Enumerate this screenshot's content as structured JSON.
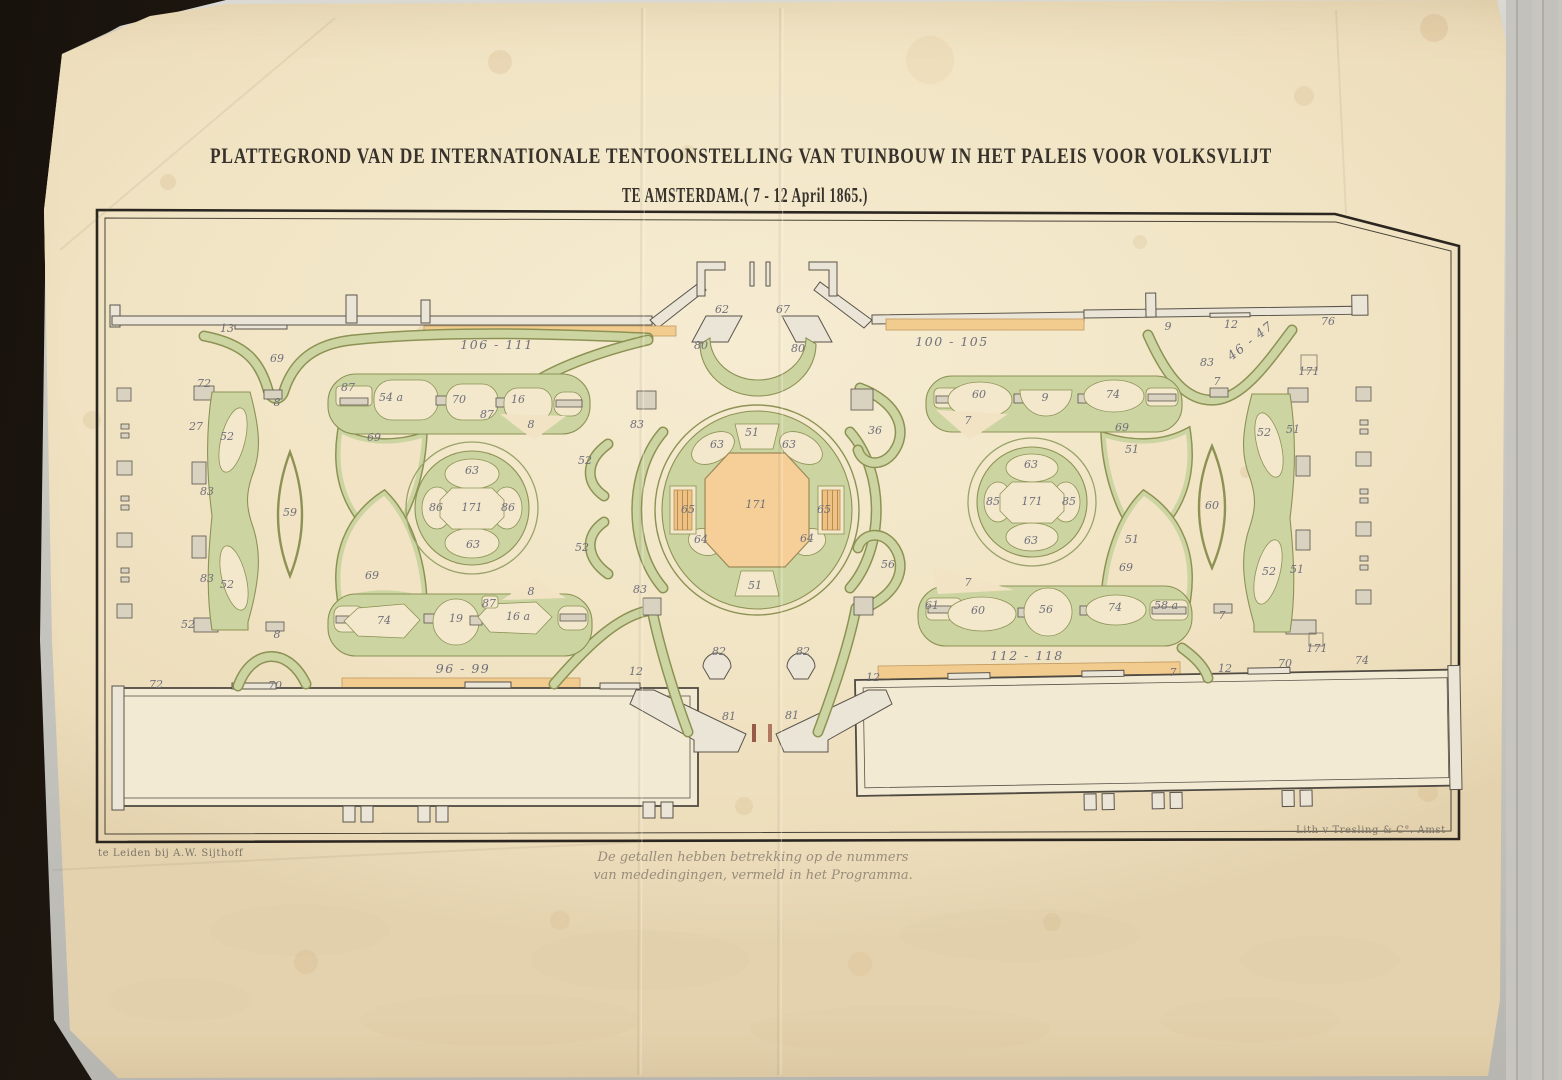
{
  "page": {
    "title_line1": "PLATTEGROND VAN DE INTERNATIONALE TENTOONSTELLING VAN TUINBOUW IN HET PALEIS VOOR VOLKSVLIJT",
    "title_line2": "TE AMSTERDAM.( 7 - 12 April 1865.)",
    "note_line1": "De getallen hebben betrekking op de nummers",
    "note_line2": "van mededingingen, vermeld in het Programma.",
    "imprint_left": "te Leiden bij A.W. Sijthoff",
    "imprint_right": "Lith v Tresling & C°. Amst"
  },
  "colors": {
    "paper": "#f1e4c4",
    "parterre_green": "#ccd5a2",
    "green_edge": "#8d9254",
    "orange": "#f2cc8f",
    "ink": "#37322b",
    "number_ink": "#6f6f7a",
    "cover_dark": "#18120c"
  },
  "plan_labels": [
    {
      "t": "13",
      "x": 227,
      "y": 332
    },
    {
      "t": "69",
      "x": 277,
      "y": 362
    },
    {
      "t": "106 - 111",
      "x": 497,
      "y": 349,
      "b": 1
    },
    {
      "t": "62",
      "x": 722,
      "y": 313
    },
    {
      "t": "67",
      "x": 783,
      "y": 313
    },
    {
      "t": "80",
      "x": 701,
      "y": 349
    },
    {
      "t": "80",
      "x": 798,
      "y": 352
    },
    {
      "t": "100 - 105",
      "x": 952,
      "y": 346,
      "b": 1
    },
    {
      "t": "9",
      "x": 1168,
      "y": 330
    },
    {
      "t": "12",
      "x": 1231,
      "y": 328
    },
    {
      "t": "76",
      "x": 1328,
      "y": 325
    },
    {
      "t": "46 - 47",
      "x": 1253,
      "y": 344,
      "b": 1,
      "r": -38
    },
    {
      "t": "83",
      "x": 1207,
      "y": 366
    },
    {
      "t": "7",
      "x": 1217,
      "y": 385
    },
    {
      "t": "171",
      "x": 1309,
      "y": 375
    },
    {
      "t": "72",
      "x": 204,
      "y": 387
    },
    {
      "t": "27",
      "x": 196,
      "y": 430
    },
    {
      "t": "52",
      "x": 227,
      "y": 440
    },
    {
      "t": "83",
      "x": 207,
      "y": 495
    },
    {
      "t": "59",
      "x": 290,
      "y": 516
    },
    {
      "t": "83",
      "x": 207,
      "y": 582
    },
    {
      "t": "52",
      "x": 227,
      "y": 588
    },
    {
      "t": "52",
      "x": 188,
      "y": 628
    },
    {
      "t": "8",
      "x": 277,
      "y": 638
    },
    {
      "t": "8",
      "x": 277,
      "y": 406
    },
    {
      "t": "87",
      "x": 348,
      "y": 391
    },
    {
      "t": "54 a",
      "x": 391,
      "y": 401
    },
    {
      "t": "70",
      "x": 459,
      "y": 403
    },
    {
      "t": "16",
      "x": 518,
      "y": 403
    },
    {
      "t": "87",
      "x": 487,
      "y": 418
    },
    {
      "t": "8",
      "x": 531,
      "y": 428
    },
    {
      "t": "69",
      "x": 374,
      "y": 441
    },
    {
      "t": "83",
      "x": 637,
      "y": 428
    },
    {
      "t": "52",
      "x": 585,
      "y": 464
    },
    {
      "t": "36",
      "x": 875,
      "y": 434
    },
    {
      "t": "63",
      "x": 472,
      "y": 474
    },
    {
      "t": "86",
      "x": 436,
      "y": 511
    },
    {
      "t": "171",
      "x": 472,
      "y": 511
    },
    {
      "t": "86",
      "x": 508,
      "y": 511
    },
    {
      "t": "63",
      "x": 473,
      "y": 548
    },
    {
      "t": "51",
      "x": 752,
      "y": 436
    },
    {
      "t": "63",
      "x": 717,
      "y": 448
    },
    {
      "t": "63",
      "x": 789,
      "y": 448
    },
    {
      "t": "65",
      "x": 688,
      "y": 513
    },
    {
      "t": "171",
      "x": 756,
      "y": 508
    },
    {
      "t": "65",
      "x": 824,
      "y": 513
    },
    {
      "t": "64",
      "x": 701,
      "y": 543
    },
    {
      "t": "64",
      "x": 807,
      "y": 542
    },
    {
      "t": "51",
      "x": 755,
      "y": 589
    },
    {
      "t": "63",
      "x": 1031,
      "y": 468
    },
    {
      "t": "85",
      "x": 993,
      "y": 505
    },
    {
      "t": "171",
      "x": 1032,
      "y": 505
    },
    {
      "t": "85",
      "x": 1069,
      "y": 505
    },
    {
      "t": "63",
      "x": 1031,
      "y": 544
    },
    {
      "t": "69",
      "x": 1122,
      "y": 431
    },
    {
      "t": "51",
      "x": 1132,
      "y": 453
    },
    {
      "t": "51",
      "x": 1132,
      "y": 543
    },
    {
      "t": "69",
      "x": 1126,
      "y": 571
    },
    {
      "t": "60",
      "x": 979,
      "y": 398
    },
    {
      "t": "9",
      "x": 1045,
      "y": 401
    },
    {
      "t": "74",
      "x": 1113,
      "y": 398
    },
    {
      "t": "7",
      "x": 968,
      "y": 424
    },
    {
      "t": "52",
      "x": 582,
      "y": 551
    },
    {
      "t": "83",
      "x": 640,
      "y": 593
    },
    {
      "t": "56",
      "x": 888,
      "y": 568
    },
    {
      "t": "7",
      "x": 968,
      "y": 586
    },
    {
      "t": "61",
      "x": 932,
      "y": 609
    },
    {
      "t": "60",
      "x": 978,
      "y": 614
    },
    {
      "t": "56",
      "x": 1046,
      "y": 613
    },
    {
      "t": "74",
      "x": 1115,
      "y": 611
    },
    {
      "t": "58 a",
      "x": 1166,
      "y": 609
    },
    {
      "t": "112 - 118",
      "x": 1027,
      "y": 660,
      "b": 1
    },
    {
      "t": "7",
      "x": 1173,
      "y": 676
    },
    {
      "t": "69",
      "x": 372,
      "y": 579
    },
    {
      "t": "8",
      "x": 531,
      "y": 595
    },
    {
      "t": "87",
      "x": 489,
      "y": 607
    },
    {
      "t": "74",
      "x": 384,
      "y": 624
    },
    {
      "t": "19",
      "x": 456,
      "y": 622
    },
    {
      "t": "16 a",
      "x": 518,
      "y": 620
    },
    {
      "t": "96 - 99",
      "x": 463,
      "y": 673,
      "b": 1
    },
    {
      "t": "52",
      "x": 1264,
      "y": 436
    },
    {
      "t": "51",
      "x": 1293,
      "y": 433
    },
    {
      "t": "60",
      "x": 1212,
      "y": 509
    },
    {
      "t": "52",
      "x": 1269,
      "y": 575
    },
    {
      "t": "51",
      "x": 1297,
      "y": 573
    },
    {
      "t": "7",
      "x": 1222,
      "y": 619
    },
    {
      "t": "171",
      "x": 1317,
      "y": 652
    },
    {
      "t": "82",
      "x": 719,
      "y": 655
    },
    {
      "t": "82",
      "x": 803,
      "y": 655
    },
    {
      "t": "12",
      "x": 636,
      "y": 675
    },
    {
      "t": "12",
      "x": 873,
      "y": 681
    },
    {
      "t": "81",
      "x": 729,
      "y": 720
    },
    {
      "t": "81",
      "x": 792,
      "y": 719
    },
    {
      "t": "72",
      "x": 156,
      "y": 688
    },
    {
      "t": "70",
      "x": 275,
      "y": 689
    },
    {
      "t": "12",
      "x": 1225,
      "y": 672
    },
    {
      "t": "70",
      "x": 1285,
      "y": 667
    },
    {
      "t": "74",
      "x": 1362,
      "y": 664
    }
  ]
}
